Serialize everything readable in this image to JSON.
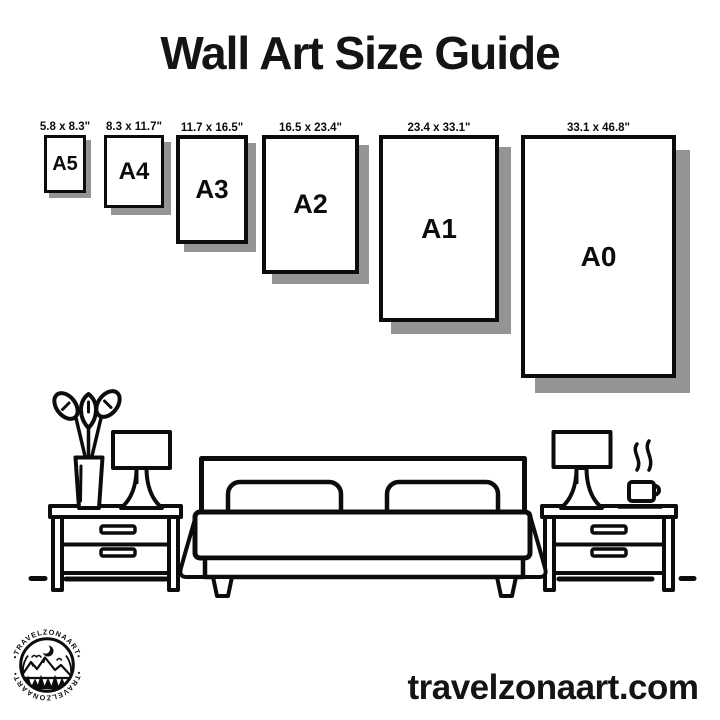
{
  "title": "Wall Art Size Guide",
  "sizes": [
    {
      "label": "A5",
      "dimensions": "5.8 x 8.3\""
    },
    {
      "label": "A4",
      "dimensions": "8.3 x 11.7\""
    },
    {
      "label": "A3",
      "dimensions": "11.7 x 16.5\""
    },
    {
      "label": "A2",
      "dimensions": "16.5 x 23.4\""
    },
    {
      "label": "A1",
      "dimensions": "23.4 x 33.1\""
    },
    {
      "label": "A0",
      "dimensions": "33.1 x 46.8\""
    }
  ],
  "logo": {
    "ring_text_top": "•TRAVELZONAART•",
    "ring_text_bottom": "•TRAVELZONAART•"
  },
  "website": "travelzonaart.com",
  "colors": {
    "ink": "#0c0c0c",
    "shadow": "#949494",
    "background": "#ffffff"
  }
}
